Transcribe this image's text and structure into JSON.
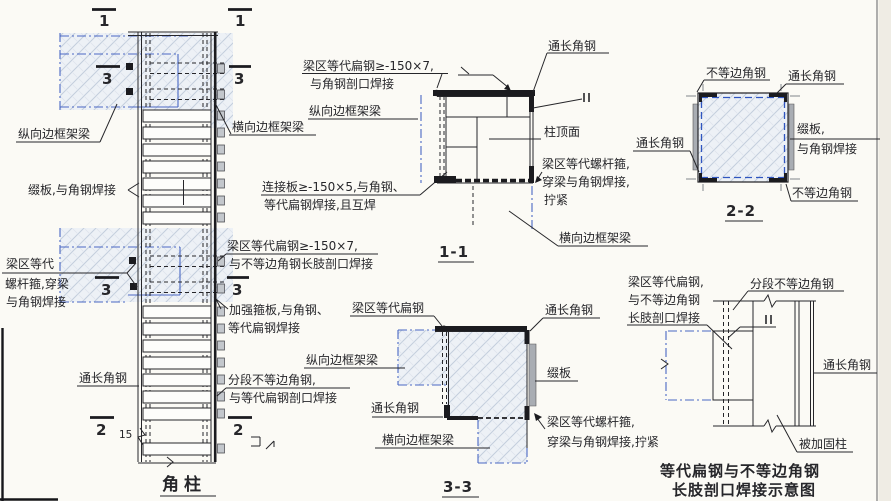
{
  "drawing": {
    "colors": {
      "line": "#26262a",
      "beam_centerline_blue": "#4a68c4",
      "hatch_fill": "#edf1f6",
      "hatch_line": "#c3cedd",
      "paper": "#fbfaf5"
    },
    "corner_column": {
      "title": "角柱",
      "markers": {
        "m1": "1",
        "m2": "2",
        "m3": "3"
      },
      "labels": {
        "longitudinal_beam": "纵向边框架梁",
        "batten_weld": "缀板,与角钢焊接",
        "bolt_l1": "梁区等代",
        "bolt_l2": "螺杆箍,穿梁",
        "bolt_l3": "与角钢焊接",
        "full_length_angle": "通长角钢",
        "transverse_beam": "横向边框架梁",
        "flat_steel_l1": "梁区等代扁钢≥-150×7,",
        "flat_steel_l2": "与不等边角钢长肢剖口焊接",
        "stiffener_l1": "加强箍板,与角钢、",
        "stiffener_l2": "等代扁钢焊接",
        "segmented_l1": "分段不等边角钢,",
        "segmented_l2": "与等代扁钢剖口焊接",
        "dim_15": "15"
      }
    },
    "section_1_1": {
      "title": "1-1",
      "labels": {
        "flat_steel_l1": "梁区等代扁钢≥-150×7,",
        "flat_steel_l2": "与角钢剖口焊接",
        "longitudinal_beam": "纵向边框架梁",
        "gusset_l1": "连接板≥-150×5,与角钢、",
        "gusset_l2": "等代扁钢焊接,且互焊",
        "full_length_angle": "通长角钢",
        "column_top": "柱顶面",
        "bolt_l1": "梁区等代螺杆箍,",
        "bolt_l2": "穿梁与角钢焊接,",
        "bolt_l3": "拧紧",
        "transverse_beam": "横向边框架梁"
      }
    },
    "section_2_2": {
      "title": "2-2",
      "labels": {
        "unequal_angle_top": "不等边角钢",
        "full_angle_top": "通长角钢",
        "full_angle_left": "通长角钢",
        "batten_l1": "缀板,",
        "batten_l2": "与角钢焊接",
        "unequal_angle_bottom": "不等边角钢"
      }
    },
    "section_3_3": {
      "title": "3-3",
      "labels": {
        "flat_steel": "梁区等代扁钢",
        "full_angle_top": "通长角钢",
        "longitudinal_beam": "纵向边框架梁",
        "full_angle_mid": "通长角钢",
        "transverse_beam": "横向边框架梁",
        "batten": "缀板",
        "bolt_l1": "梁区等代螺杆箍,",
        "bolt_l2": "穿梁与角钢焊接,拧紧"
      }
    },
    "weld_schematic": {
      "title_l1": "等代扁钢与不等边角钢",
      "title_l2": "长肢剖口焊接示意图",
      "labels": {
        "flat_steel_l1": "梁区等代扁钢,",
        "flat_steel_l2": "与不等边角钢",
        "flat_steel_l3": "长肢剖口焊接",
        "segmented_angle": "分段不等边角钢",
        "full_length_angle": "通长角钢",
        "reinforced_column": "被加固柱"
      }
    }
  }
}
